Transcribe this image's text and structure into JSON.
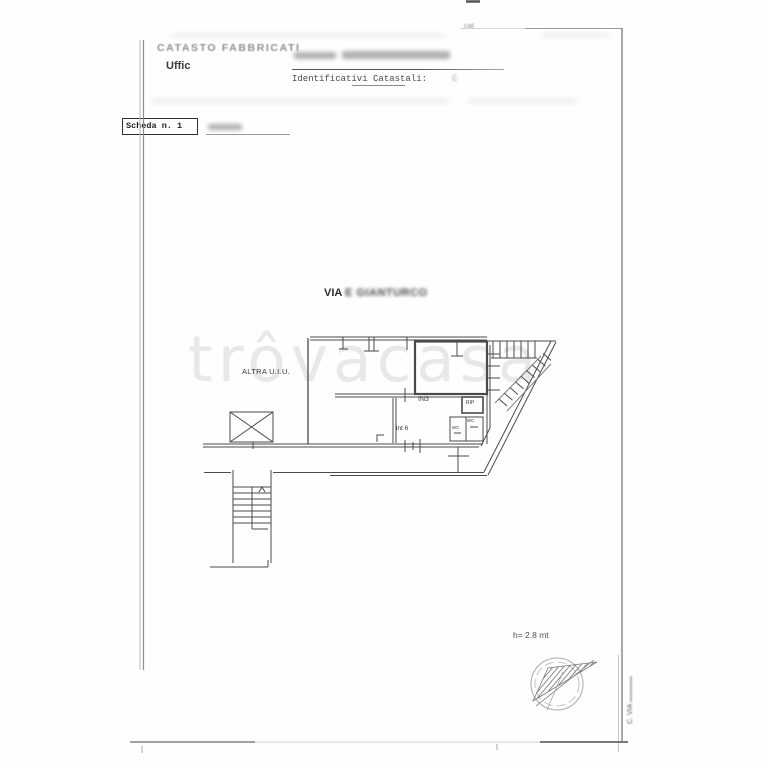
{
  "document": {
    "header": {
      "registry_title": "CATASTO FABBRICATI",
      "office_label": "Uffic",
      "identifiers_label": "Identificativi Catastali:",
      "identifiers_value": "C",
      "corner_note": "cat",
      "sheet_label": "Scheda n. 1"
    },
    "plan": {
      "street_prefix": "VIA",
      "street_name_redacted": "E GIANTURCO",
      "labels": {
        "other_unit": "ALTRA U.I.U.",
        "room_in3": "IN3",
        "storage": "RIP",
        "wc_left": "WC",
        "wc_right": "WC",
        "internal_number": "int 6"
      },
      "ceiling_height_note": "h= 2.8 mt"
    },
    "watermark": "trôvacasa",
    "side_annotation": {
      "line1": "C.",
      "line2": "VIA"
    }
  },
  "colors": {
    "paper": "#fefefe",
    "ink": "#4a4a4a",
    "faded_ink": "#8f8f8f",
    "watermark": "rgba(0,0,0,0.085)"
  }
}
